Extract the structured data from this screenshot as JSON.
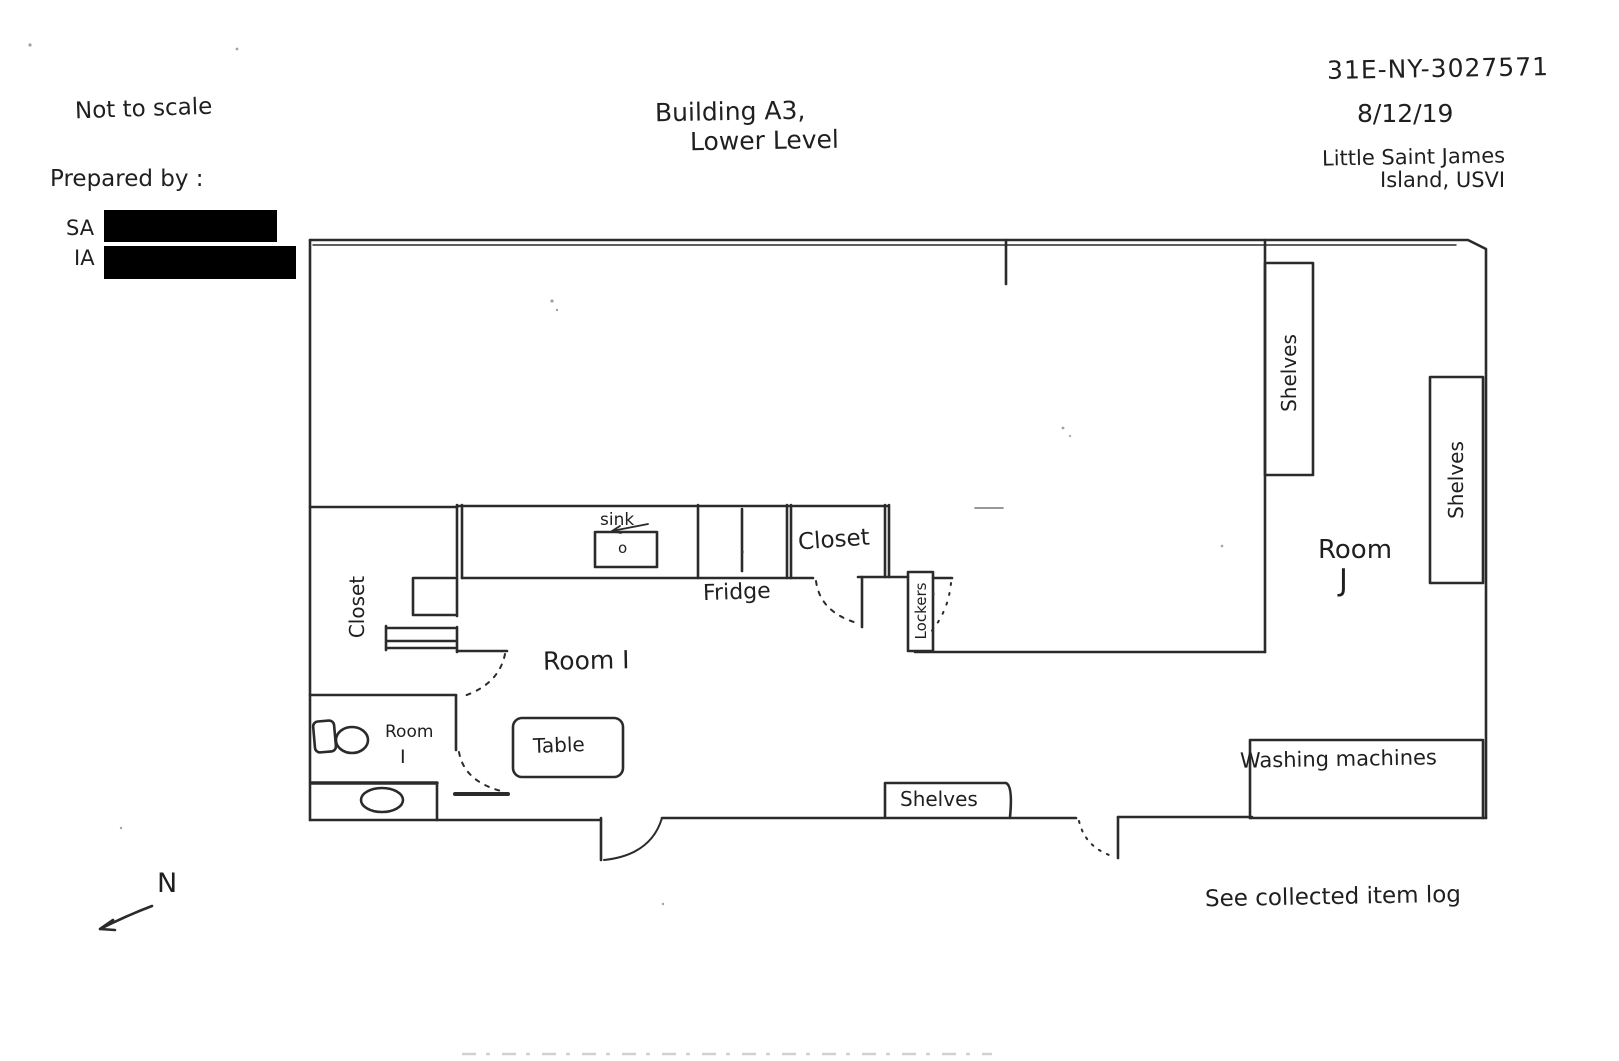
{
  "meta": {
    "not_to_scale": "Not to scale",
    "prepared_by": "Prepared by :",
    "preparer_roles": [
      "SA",
      "IA"
    ],
    "title_line1": "Building A3,",
    "title_line2": "Lower Level",
    "case_number": "31E-NY-3027571",
    "date": "8/12/19",
    "location_line1": "Little Saint James",
    "location_line2": "Island, USVI",
    "see_log": "See collected item log",
    "north": "N"
  },
  "plan": {
    "labels": {
      "shelves_left": "Shelves",
      "shelves_right": "Shelves",
      "room_j_line1": "Room",
      "room_j_line2": "J",
      "closet_left": "Closet",
      "sink": "sink",
      "sink_mark": "o",
      "fridge": "Fridge",
      "closet_center": "Closet",
      "lockers": "Lockers",
      "room_i_main": "Room I",
      "room_i_small_line1": "Room",
      "room_i_small_line2": "I",
      "table": "Table",
      "shelves_bottom": "Shelves",
      "washing_machines": "Washing machines"
    }
  },
  "colors": {
    "ink": "#2b2b2b",
    "paper": "#ffffff",
    "redaction": "#000000"
  }
}
